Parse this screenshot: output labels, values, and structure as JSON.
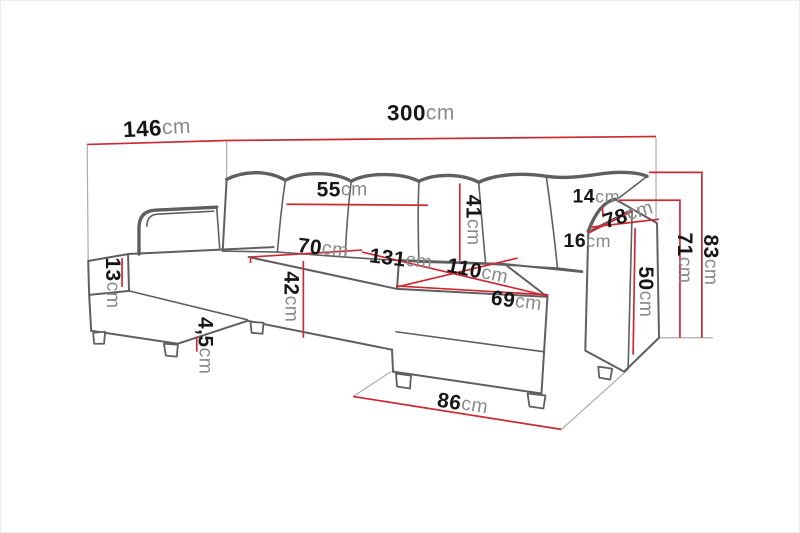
{
  "palette": {
    "dimension_line_red": "#cb2a33",
    "sofa_outline_gray": "#5f5f62",
    "extension_line_gray": "#ababab",
    "number_color": "#161616",
    "unit_color": "#8a8a8a",
    "background": "#ffffff"
  },
  "dims": {
    "left_section_depth": {
      "value": "146",
      "unit": "cm"
    },
    "total_width": {
      "value": "300",
      "unit": "cm"
    },
    "back_cushion_width": {
      "value": "55",
      "unit": "cm"
    },
    "back_cushion_height": {
      "value": "41",
      "unit": "cm"
    },
    "armrest_top_width": {
      "value": "14",
      "unit": "cm"
    },
    "armrest_depth": {
      "value": "78",
      "unit": "cm"
    },
    "armrest_front_width": {
      "value": "16",
      "unit": "cm"
    },
    "armrest_height": {
      "value": "71",
      "unit": "cm"
    },
    "total_height": {
      "value": "83",
      "unit": "cm"
    },
    "seat_depth": {
      "value": "70",
      "unit": "cm"
    },
    "seat_width": {
      "value": "131",
      "unit": "cm"
    },
    "chaise_length": {
      "value": "110",
      "unit": "cm"
    },
    "chaise_front_width": {
      "value": "69",
      "unit": "cm"
    },
    "chaise_height": {
      "value": "50",
      "unit": "cm"
    },
    "seat_height": {
      "value": "42",
      "unit": "cm"
    },
    "cushion_thickness": {
      "value": "13",
      "unit": "cm"
    },
    "leg_height": {
      "value": "4,5",
      "unit": "cm"
    },
    "front_clearance": {
      "value": "86",
      "unit": "cm"
    }
  }
}
